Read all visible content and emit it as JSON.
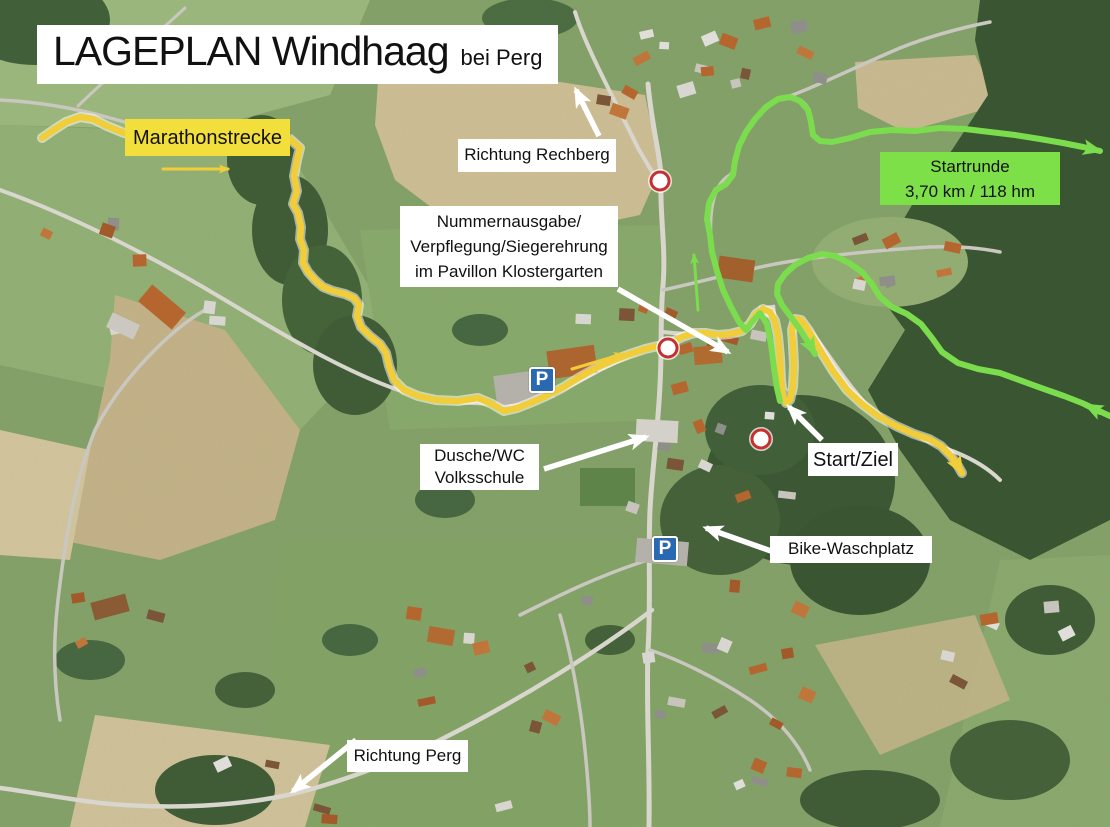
{
  "title": {
    "main": "LAGEPLAN Windhaag",
    "suffix": "bei Perg"
  },
  "legend": {
    "marathonstrecke": "Marathonstrecke",
    "startrunde": [
      "Startrunde",
      "3,70 km / 118 hm"
    ]
  },
  "annotations": {
    "richtung_rechberg": "Richtung Rechberg",
    "nummernausgabe": [
      "Nummernausgabe/",
      "Verpflegung/Siegerehrung",
      "im Pavillon Klostergarten"
    ],
    "dusche_wc": [
      "Dusche/WC",
      "Volksschule"
    ],
    "start_ziel": "Start/Ziel",
    "bike_waschplatz": "Bike-Waschplatz",
    "richtung_perg": "Richtung Perg"
  },
  "parking_label": "P",
  "colors": {
    "route_yellow": "#f1ce39",
    "route_green": "#7bdd4e",
    "box_yellow": "#f2df3c",
    "box_green": "#7de049",
    "label_bg": "#ffffff",
    "text": "#111111",
    "closure_red": "#c53030",
    "parking_blue": "#2a69b2",
    "arrow_white": "#ffffff"
  },
  "map_data": {
    "routes": [
      {
        "name": "marathonstrecke-route",
        "color_key": "route_yellow",
        "width": 6.5,
        "halo": true,
        "arrow": "yellow",
        "points": [
          [
            42,
            138
          ],
          [
            52,
            131
          ],
          [
            66,
            122
          ],
          [
            80,
            117
          ],
          [
            93,
            119
          ],
          [
            107,
            126
          ],
          [
            124,
            133
          ],
          [
            146,
            137
          ],
          [
            175,
            138
          ],
          [
            210,
            137
          ],
          [
            245,
            135
          ],
          [
            272,
            135
          ],
          [
            290,
            139
          ],
          [
            300,
            148
          ],
          [
            297,
            160
          ],
          [
            294,
            176
          ],
          [
            297,
            191
          ],
          [
            293,
            204
          ],
          [
            298,
            213
          ],
          [
            301,
            227
          ],
          [
            300,
            239
          ],
          [
            304,
            250
          ],
          [
            303,
            263
          ],
          [
            308,
            272
          ],
          [
            315,
            280
          ],
          [
            323,
            287
          ],
          [
            333,
            291
          ],
          [
            345,
            294
          ],
          [
            354,
            298
          ],
          [
            359,
            305
          ],
          [
            357,
            316
          ],
          [
            361,
            327
          ],
          [
            370,
            336
          ],
          [
            380,
            344
          ],
          [
            386,
            353
          ],
          [
            389,
            366
          ],
          [
            394,
            380
          ],
          [
            404,
            390
          ],
          [
            418,
            396
          ],
          [
            436,
            400
          ],
          [
            458,
            401
          ],
          [
            478,
            398
          ],
          [
            492,
            404
          ],
          [
            504,
            411
          ],
          [
            517,
            408
          ],
          [
            530,
            403
          ],
          [
            546,
            396
          ],
          [
            562,
            388
          ],
          [
            580,
            377
          ],
          [
            598,
            367
          ],
          [
            614,
            360
          ],
          [
            630,
            354
          ],
          [
            645,
            349
          ],
          [
            658,
            346
          ],
          [
            670,
            343
          ],
          [
            682,
            337
          ],
          [
            694,
            333
          ],
          [
            706,
            333
          ],
          [
            718,
            335
          ],
          [
            730,
            334
          ],
          [
            742,
            331
          ],
          [
            750,
            324
          ],
          [
            756,
            314
          ],
          [
            763,
            309
          ],
          [
            770,
            312
          ],
          [
            775,
            321
          ],
          [
            778,
            336
          ],
          [
            780,
            358
          ],
          [
            781,
            380
          ],
          [
            783,
            396
          ],
          [
            786,
            403
          ],
          [
            790,
            400
          ],
          [
            793,
            387
          ],
          [
            794,
            366
          ],
          [
            793,
            345
          ],
          [
            792,
            330
          ],
          [
            795,
            319
          ],
          [
            801,
            320
          ],
          [
            809,
            331
          ],
          [
            820,
            350
          ],
          [
            833,
            371
          ],
          [
            847,
            390
          ],
          [
            862,
            404
          ],
          [
            878,
            416
          ],
          [
            896,
            426
          ],
          [
            914,
            434
          ],
          [
            929,
            439
          ],
          [
            941,
            446
          ],
          [
            951,
            456
          ],
          [
            958,
            466
          ],
          [
            962,
            473
          ]
        ]
      },
      {
        "name": "startrunde-route-out",
        "color_key": "route_green",
        "width": 6,
        "halo": false,
        "arrow": "green",
        "points": [
          [
            780,
            401
          ],
          [
            777,
            388
          ],
          [
            774,
            368
          ],
          [
            771,
            344
          ],
          [
            767,
            324
          ],
          [
            760,
            313
          ],
          [
            752,
            322
          ],
          [
            746,
            330
          ],
          [
            739,
            322
          ],
          [
            731,
            307
          ],
          [
            723,
            290
          ],
          [
            717,
            271
          ],
          [
            712,
            252
          ],
          [
            710,
            235
          ],
          [
            707,
            219
          ],
          [
            709,
            203
          ],
          [
            716,
            190
          ],
          [
            726,
            184
          ],
          [
            733,
            175
          ],
          [
            735,
            161
          ],
          [
            739,
            146
          ],
          [
            746,
            132
          ],
          [
            755,
            119
          ],
          [
            766,
            107
          ],
          [
            778,
            99
          ],
          [
            790,
            97
          ],
          [
            800,
            101
          ],
          [
            808,
            110
          ],
          [
            811,
            122
          ],
          [
            813,
            135
          ],
          [
            820,
            141
          ],
          [
            832,
            142
          ],
          [
            850,
            138
          ],
          [
            870,
            132
          ],
          [
            892,
            130
          ],
          [
            915,
            131
          ],
          [
            940,
            128
          ],
          [
            965,
            129
          ],
          [
            990,
            132
          ],
          [
            1015,
            135
          ],
          [
            1040,
            139
          ],
          [
            1063,
            143
          ],
          [
            1083,
            147
          ],
          [
            1100,
            151
          ]
        ]
      },
      {
        "name": "startrunde-route-return",
        "color_key": "route_green",
        "width": 6,
        "halo": false,
        "arrow": "green",
        "points": [
          [
            1110,
            416
          ],
          [
            1097,
            410
          ],
          [
            1082,
            403
          ],
          [
            1064,
            396
          ],
          [
            1044,
            389
          ],
          [
            1022,
            381
          ],
          [
            1000,
            373
          ],
          [
            978,
            369
          ],
          [
            958,
            363
          ],
          [
            942,
            352
          ],
          [
            932,
            338
          ],
          [
            921,
            324
          ],
          [
            907,
            314
          ],
          [
            892,
            307
          ],
          [
            880,
            297
          ],
          [
            872,
            284
          ],
          [
            862,
            272
          ],
          [
            849,
            263
          ],
          [
            835,
            256
          ],
          [
            822,
            254
          ],
          [
            808,
            258
          ],
          [
            795,
            265
          ],
          [
            785,
            274
          ],
          [
            778,
            284
          ],
          [
            777,
            294
          ],
          [
            782,
            305
          ],
          [
            791,
            317
          ],
          [
            801,
            331
          ],
          [
            810,
            345
          ],
          [
            815,
            354
          ]
        ]
      }
    ],
    "direction_arrows": [
      {
        "name": "marathon-direction-arrow",
        "color_key": "route_yellow",
        "width": 3,
        "head": "yellow-sm",
        "points": [
          [
            163,
            169
          ],
          [
            228,
            169
          ]
        ]
      },
      {
        "name": "road-direction-arrow",
        "color_key": "route_yellow",
        "width": 3,
        "head": "yellow-sm",
        "points": [
          [
            572,
            369
          ],
          [
            623,
            354
          ]
        ]
      },
      {
        "name": "startrunde-up-arrow",
        "color_key": "route_green",
        "width": 3,
        "head": "green-sm",
        "points": [
          [
            698,
            310
          ],
          [
            694,
            255
          ]
        ]
      },
      {
        "name": "startrunde-return-edge-arrow",
        "color_key": "route_green",
        "width": 6,
        "head": "green",
        "points": [
          [
            1100,
            412
          ],
          [
            1086,
            405
          ]
        ]
      }
    ],
    "annotation_arrows": [
      {
        "name": "rechberg-arrow",
        "points": [
          [
            599,
            136
          ],
          [
            576,
            90
          ]
        ]
      },
      {
        "name": "nummernausgabe-arrow",
        "points": [
          [
            618,
            289
          ],
          [
            728,
            352
          ]
        ]
      },
      {
        "name": "dusche-arrow",
        "points": [
          [
            544,
            469
          ],
          [
            646,
            437
          ]
        ]
      },
      {
        "name": "startziel-arrow",
        "points": [
          [
            822,
            440
          ],
          [
            789,
            407
          ]
        ]
      },
      {
        "name": "bike-arrow",
        "points": [
          [
            771,
            551
          ],
          [
            706,
            528
          ]
        ]
      },
      {
        "name": "perg-arrow",
        "points": [
          [
            356,
            740
          ],
          [
            293,
            791
          ]
        ]
      }
    ],
    "closure_markers": [
      {
        "x": 660,
        "y": 181
      },
      {
        "x": 668,
        "y": 348
      },
      {
        "x": 761,
        "y": 439
      }
    ],
    "parking_signs": [
      {
        "x": 529,
        "y": 367
      },
      {
        "x": 652,
        "y": 536
      }
    ]
  }
}
